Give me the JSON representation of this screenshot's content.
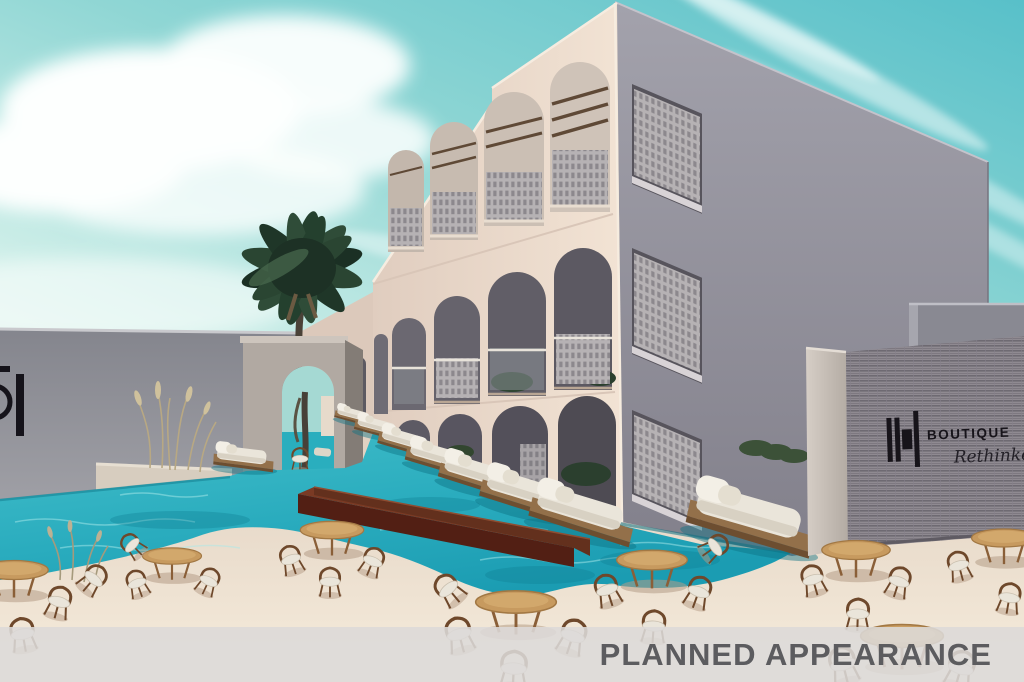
{
  "banner": {
    "label": "PLANNED APPEARANCE"
  },
  "signage": {
    "right_wall_sign": {
      "logo_mark": "DH",
      "brand": "BOUTIQUE",
      "tagline": "Rethinked"
    },
    "left_wall_sign": {
      "logo_mark": "DH (cropped at image edge)"
    }
  },
  "scene": {
    "description": "Architectural concept rendering of a boutique hotel courtyard: a three-storey cream building with arched balconies and rooftop pergolas, a turquoise pool with wooden daybed platforms, sandy deck with round wooden dining tables and chairs, a palm tree over an arched passage, and grey signage walls.",
    "elements": [
      "teal sky with white clouds",
      "arched hotel facade",
      "perforated breeze-block balcony screens",
      "rooftop pergola beams",
      "left boundary wall with cropped DH logo",
      "arched portal passage",
      "palm tree",
      "swimming pool",
      "daybed platforms over water",
      "rust-brown planter bench",
      "round dining tables with chairs",
      "ornamental grasses",
      "ribbed grey signage wall with DH BOUTIQUE Rethinked logo",
      "translucent caption band"
    ],
    "counts": {
      "pool_daybeds": 9,
      "dining_tables": 8,
      "dining_chairs": 22,
      "palm_trees": 1
    }
  },
  "palette": {
    "sky_deep_teal": "#5fc3cb",
    "sky_light": "#d6f0ea",
    "cloud_white": "#fdfffe",
    "facade_cream": "#f0e0d2",
    "facade_shade": "#dcc9bb",
    "side_wall_grey": "#94929c",
    "arch_interior": "#55525b",
    "breeze_block_grey": "#b6b2b4",
    "pergola_wood": "#5f4936",
    "pool_turquoise": "#2eb4c3",
    "pool_deep": "#1593a8",
    "pool_ripple": "#a9e9ea",
    "deck_sand": "#ecdfcf",
    "table_wood": "#c79a5f",
    "chair_wood": "#6e482b",
    "cushion_white": "#eae5da",
    "planter_rust": "#6b3322",
    "textured_wall_grey": "#8f8a91",
    "sign_black": "#17141a",
    "banner_background": "#dcd8d7",
    "banner_text": "#5c5c5f"
  }
}
